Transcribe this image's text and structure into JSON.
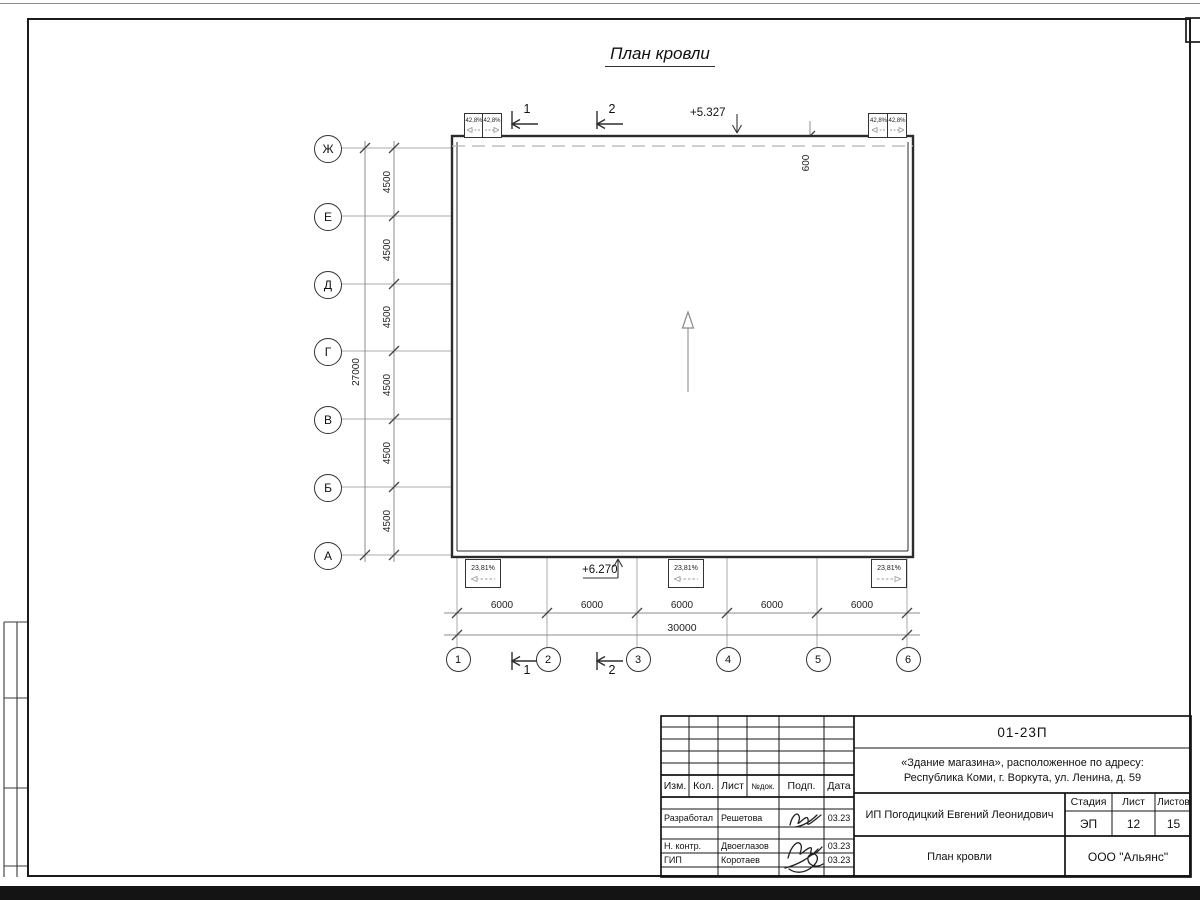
{
  "sheet": {
    "title": "План кровли"
  },
  "axes": {
    "rows": [
      "Ж",
      "Е",
      "Д",
      "Г",
      "В",
      "Б",
      "А"
    ],
    "cols": [
      "1",
      "2",
      "3",
      "4",
      "5",
      "6"
    ],
    "row_dims": [
      "4500",
      "4500",
      "4500",
      "4500",
      "4500",
      "4500"
    ],
    "row_total": "27000",
    "col_dims": [
      "6000",
      "6000",
      "6000",
      "6000",
      "6000"
    ],
    "col_total": "30000"
  },
  "annotations": {
    "elevation_top": "+5.327",
    "elevation_bottom": "+6.270",
    "parapet_dim": "600",
    "main_slope": "1,89 %",
    "canopy_slope": "42,8%",
    "ramp_slope": "23,81%",
    "section_1": "1",
    "section_2": "2"
  },
  "titleblock": {
    "doc_code": "01-23П",
    "object_line1": "«Здание магазина», расположенное по адресу:",
    "object_line2": "Республика Коми, г. Воркута, ул. Ленина, д. 59",
    "client": "ИП Погодицкий Евгений Леонидович",
    "drawing_name": "План кровли",
    "organization": "ООО \"Альянс\"",
    "stage_label": "Стадия",
    "stage_value": "ЭП",
    "sheet_label": "Лист",
    "sheet_value": "12",
    "sheets_label": "Листов",
    "sheets_value": "15",
    "columns": {
      "izm": "Изм.",
      "kol": "Кол.",
      "list": "Лист",
      "ndok": "№док.",
      "podp": "Подп.",
      "data": "Дата"
    },
    "signers": [
      {
        "role": "Разработал",
        "name": "Решетова",
        "date": "03.23"
      },
      {
        "role": "Н. контр.",
        "name": "Двоеглазов",
        "date": "03.23"
      },
      {
        "role": "ГИП",
        "name": "Коротаев",
        "date": "03.23"
      }
    ]
  }
}
